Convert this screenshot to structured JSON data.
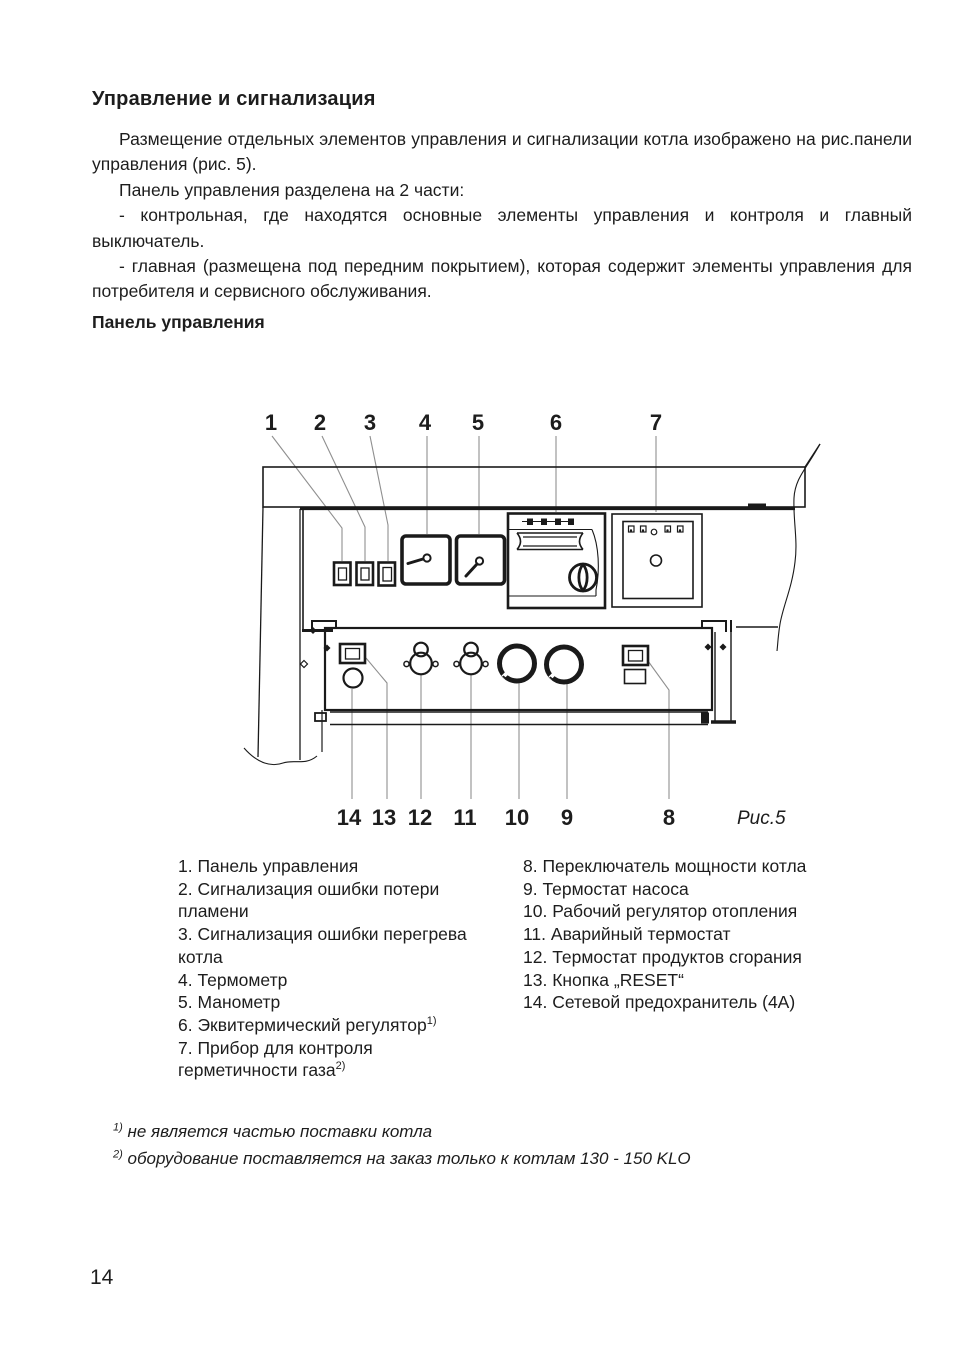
{
  "page": {
    "title": "Управление и сигнализация",
    "paragraphs": [
      "Размещение отдельных элементов управления и сигнализации котла изображено на рис.панели управления (рис. 5).",
      "Панель управления разделена на 2 части:",
      "- контрольная, где находятся  основные элементы управления и контроля и главный выключатель.",
      "- главная (размещена под передним покрытием), которая содержит элементы управления для потребителя и сервисного обслуживания."
    ],
    "section_heading": "Панель управления",
    "page_number": "14"
  },
  "diagram": {
    "caption": "Рис.5",
    "callouts_top": [
      "1",
      "2",
      "3",
      "4",
      "5",
      "6",
      "7"
    ],
    "callouts_bottom": [
      "14",
      "13",
      "12",
      "11",
      "10",
      "9",
      "8"
    ]
  },
  "legend": {
    "left": [
      {
        "text": "1. Панель управления",
        "sup": ""
      },
      {
        "text": "2. Сигнализация ошибки потери пламени",
        "sup": ""
      },
      {
        "text": "3. Сигнализация ошибки перегрева котла",
        "sup": ""
      },
      {
        "text": "4. Термометр",
        "sup": ""
      },
      {
        "text": "5. Манометр",
        "sup": ""
      },
      {
        "text": "6. Эквитермический регулятор",
        "sup": "1)"
      },
      {
        "text": "7. Прибор для контроля герметичности газа",
        "sup": "2)"
      }
    ],
    "right": [
      {
        "text": "8. Переключатель мощности котла",
        "sup": ""
      },
      {
        "text": "9. Термостат насоса",
        "sup": ""
      },
      {
        "text": "10. Рабочий регулятор отопления",
        "sup": ""
      },
      {
        "text": "11. Аварийный термостат",
        "sup": ""
      },
      {
        "text": "12. Термостат продуктов сгорания",
        "sup": ""
      },
      {
        "text": "13. Кнопка „RESET“",
        "sup": ""
      },
      {
        "text": "14. Сетевой предохранитель (4А)",
        "sup": ""
      }
    ]
  },
  "footnotes": [
    {
      "sup": "1)",
      "text": "не является  частью поставки котла"
    },
    {
      "sup": "2)",
      "text": "оборудование поставляется на заказ только к котлам  130 - 150 KLO"
    }
  ],
  "colors": {
    "ink": "#1d1d1d",
    "diagram_line": "#1a1a1a",
    "pointer_line": "#8f8f8f",
    "background": "#ffffff"
  }
}
